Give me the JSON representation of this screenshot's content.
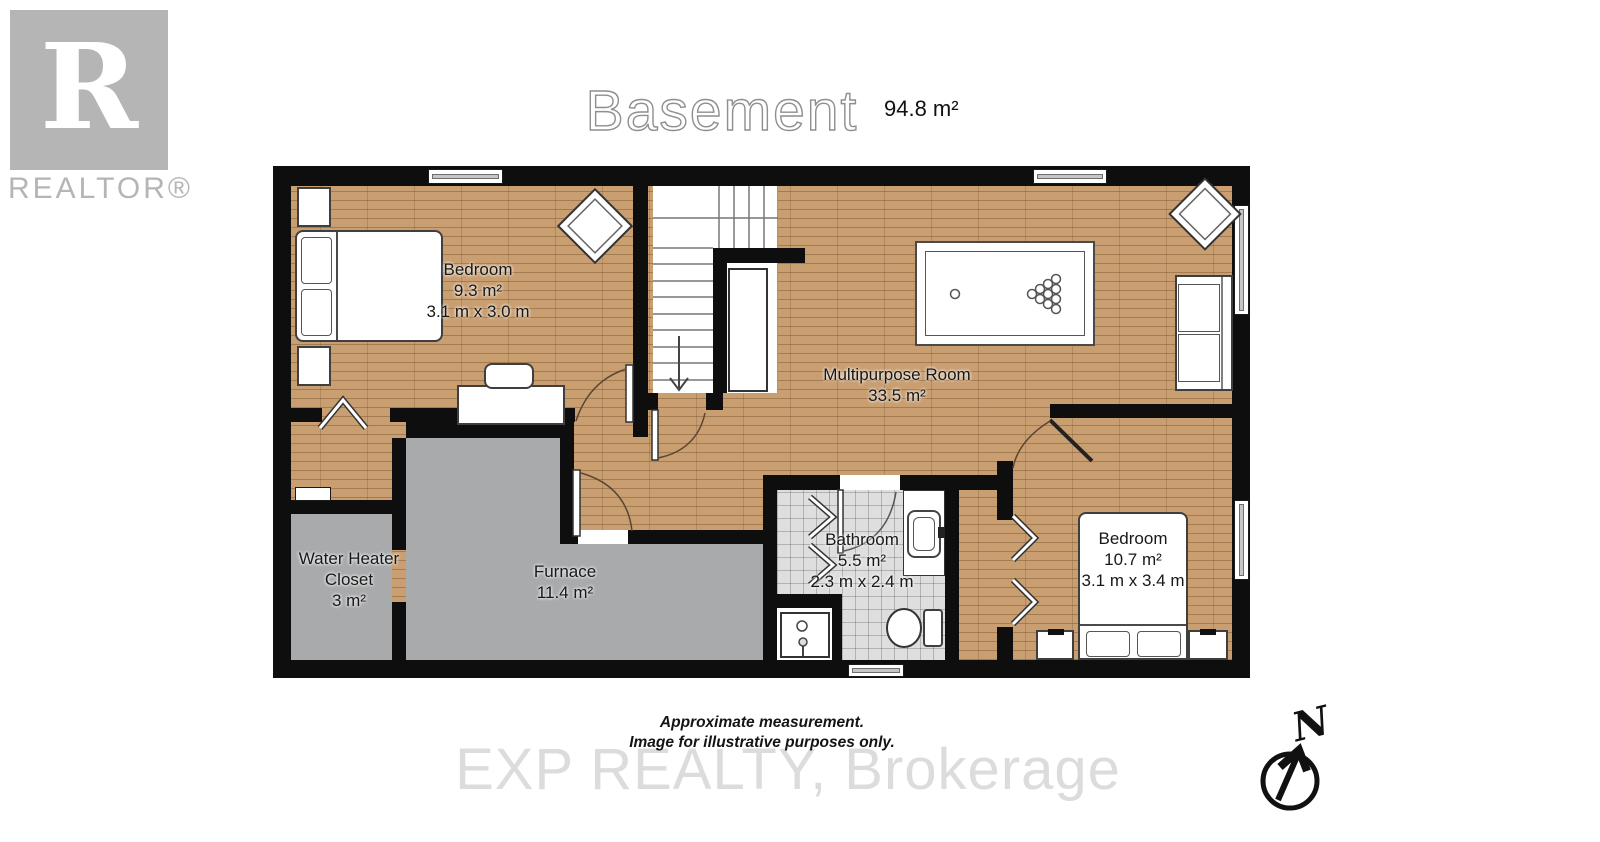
{
  "header": {
    "title": "Basement",
    "area": "94.8 m²"
  },
  "logo": {
    "letter": "R",
    "label": "REALTOR®"
  },
  "rooms": {
    "bedroom1": {
      "name": "Bedroom",
      "area": "9.3 m²",
      "dims": "3.1 m x 3.0 m"
    },
    "multipurpose": {
      "name": "Multipurpose Room",
      "area": "33.5 m²"
    },
    "water_heater": {
      "line1": "Water Heater",
      "line2": "Closet",
      "area": "3 m²"
    },
    "furnace": {
      "name": "Furnace",
      "area": "11.4 m²"
    },
    "bathroom": {
      "name": "Bathroom",
      "area": "5.5 m²",
      "dims": "2.3 m x 2.4 m"
    },
    "bedroom2": {
      "name": "Bedroom",
      "area": "10.7 m²",
      "dims": "3.1 m x 3.4 m"
    }
  },
  "footer": {
    "note1": "Approximate measurement.",
    "note2": "Image for illustrative purposes only.",
    "watermark": "EXP REALTY, Brokerage"
  },
  "compass": {
    "label": "N"
  },
  "colors": {
    "wood_floor": "#c99e71",
    "concrete_floor": "#a9aaac",
    "tile_floor": "#dedede",
    "wall": "#0e0e0e",
    "window_glass": "#c6c6c6",
    "logo_gray": "#b5b5b5",
    "watermark_gray": "#dcdcdc"
  }
}
